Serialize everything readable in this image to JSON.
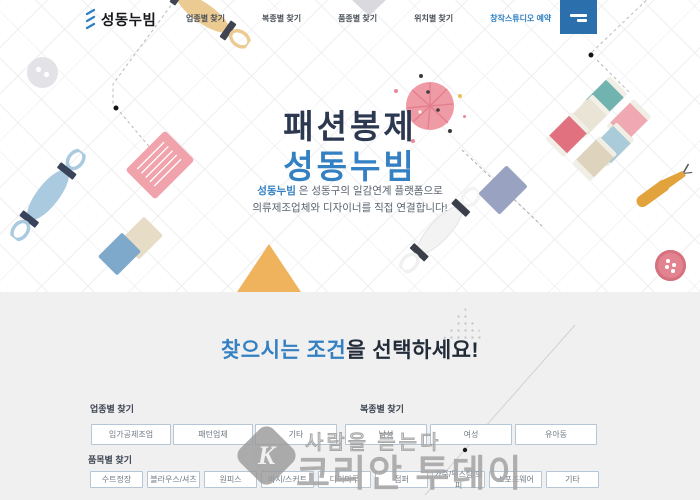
{
  "header": {
    "logo_text": "성동누빔",
    "nav": [
      {
        "label": "업종별 찾기"
      },
      {
        "label": "복종별 찾기"
      },
      {
        "label": "품종별 찾기"
      },
      {
        "label": "위치별 찾기"
      },
      {
        "label": "창작스튜디오 예약"
      }
    ]
  },
  "hero": {
    "title_line1": "패션봉제",
    "title_line2": "성동누빔",
    "subtitle_highlight": "성동누빔",
    "subtitle_rest1": " 은 성동구의 일감연계 플랫폼으로",
    "subtitle_line2": "의류제조업체와 디자이너를 직접 연결합니다!"
  },
  "finder": {
    "heading_highlight": "찾으시는 조건",
    "heading_rest": "을 선택하세요!",
    "groups": [
      {
        "label": "업종별 찾기",
        "options": [
          "임가공제조업",
          "패턴업체",
          "기타"
        ]
      },
      {
        "label": "복종별 찾기",
        "options": [
          "남성",
          "여성",
          "유아동"
        ]
      },
      {
        "label": "품목별 찾기",
        "options": [
          "수트정장",
          "블라우스/셔츠",
          "원피스",
          "바지/스커트",
          "다이마루",
          "점퍼",
          "가죽/무스탕/모피",
          "스포츠웨어",
          "기타"
        ]
      }
    ]
  },
  "watermark": {
    "logo_letter": "K",
    "tagline": "사람을 듣는다",
    "brand": "코리안 투데이"
  },
  "icons": {
    "logo_mark": "stitch-zigzag",
    "menu": "hamburger-two-lines",
    "hero_decorations": [
      "button",
      "embroidery-floss",
      "needle-case",
      "pincushion",
      "thread-spools",
      "seam-ripper",
      "fabric-bolt",
      "fabric-swatches",
      "pinked-triangle-fabric",
      "tassel-cord"
    ]
  },
  "colors": {
    "accent_blue": "#3380c2",
    "menu_button_blue": "#2c6fad",
    "title_dark": "#2b3850",
    "section_bg": "#f0f0f1",
    "watermark_gray": "#a6a6a6"
  }
}
